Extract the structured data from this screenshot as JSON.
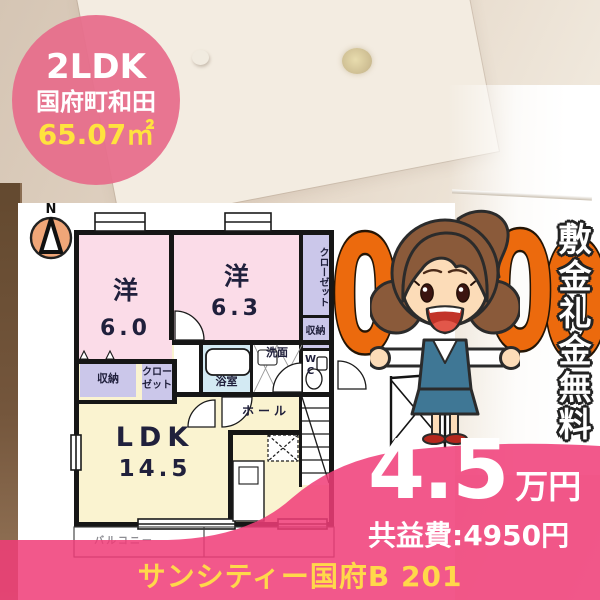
{
  "badge": {
    "type_label": "2LDK",
    "area_name": "国府町和田",
    "floor_area": "65.07㎡"
  },
  "floorplan": {
    "compass": "N",
    "bedroom1": {
      "label": "洋",
      "size": "6.0"
    },
    "bedroom2": {
      "label": "洋",
      "size": "6.3"
    },
    "closet_right": "クローゼット",
    "storage_right": "収納",
    "toilet": "WC",
    "bath": "浴室",
    "washroom": "洗面",
    "storage_left": "収納",
    "closet_left": "クローゼット",
    "hall": "ホール",
    "ldk": {
      "label": "LDK",
      "size": "14.5"
    },
    "balcony": "バルコニー"
  },
  "promo": {
    "zeros": [
      "0",
      "0",
      "0"
    ],
    "banner_vertical": "敷金礼金無料"
  },
  "price": {
    "rent": "4.5",
    "unit": "万円",
    "common_fee": "共益費:4950円"
  },
  "footer": {
    "property_name": "サンシティー国府B 201"
  },
  "colors": {
    "accent_pink": "#f03c78",
    "badge_pink": "#e76d8b",
    "zero_orange": "#ec6a0d",
    "highlight_yellow": "#ffe33e",
    "footer_yellow": "#ffd84a",
    "room_pink": "#fbdce8",
    "room_yellow": "#faf3d0",
    "room_blue": "#d3eaf3",
    "room_purple": "#cbc7ea"
  }
}
